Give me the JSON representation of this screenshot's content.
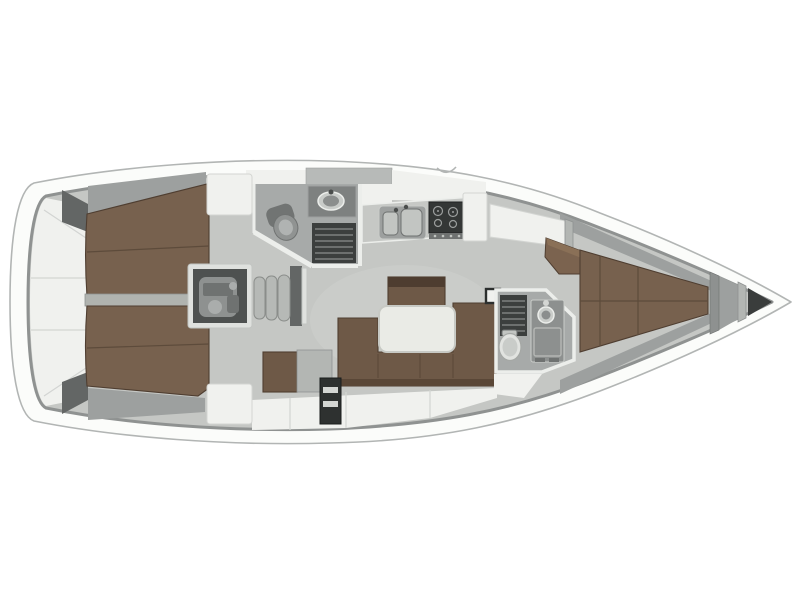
{
  "meta": {
    "description": "Sailing yacht interior floor plan, top-down view, bow pointing right",
    "view": "top-down",
    "bow_direction": "right"
  },
  "colors": {
    "background": "#ffffff",
    "hull_fill": "#fbfcfa",
    "hull_stroke": "#b2b5b4",
    "bulwark": "#8f9291",
    "floor": "#c5c7c4",
    "floor_light": "#cdcfcc",
    "room_floor": "#a7aaa9",
    "deck_white": "#f0f1ee",
    "deck_seam": "#d3d5d2",
    "liner": "#9da09f",
    "wall_white": "#eceeeb",
    "wall_grey": "#b0b3af",
    "bulkhead_dark": "#636665",
    "berth": "#77614e",
    "berth_seam": "#5d4b3b",
    "berth_edge": "#4f3e31",
    "settee": "#6e5947",
    "settee_dark": "#5a4737",
    "island_top": "#4e3d30",
    "wedge": "#7b634f",
    "wedge_top": "#8a7057",
    "table": "#eaebe6",
    "table_edge": "#c7c9c4",
    "counter": "#c6c8c5",
    "counter_dark": "#7e8180",
    "steel": "#9da09f",
    "basin": "#c2c5c2",
    "stove": "#343736",
    "burner": "#9b9e9d",
    "engine_box": "#4e5150",
    "engine_metal": "#8e9190",
    "engine_detail": "#6f7271",
    "step": "#b6b9b6",
    "step_edge": "#8a8d8a",
    "grate": "#3c3f3e",
    "grate_slat": "#6d706f",
    "toilet_grey": "#909392",
    "toilet_white": "#e1e3e0",
    "locker_dark": "#2e3130",
    "locker_slat": "#d4d6d3",
    "cabinet_grey": "#b3b6b3",
    "console": "#8d908f",
    "frame_white": "#dfe1de",
    "hatch": "#b7bab8",
    "mast_frame": "#2c2f2e",
    "anchor": "#3a3d3c",
    "sink_rim": "#c9ccc9",
    "sink_bowl": "#8b8e8d",
    "dark_detail": "#4a4d4c"
  },
  "layout": {
    "rooms": [
      {
        "id": "lazarette",
        "name": "stern lazarette storage",
        "features": [
          "storage-panels",
          "corner-bulkheads"
        ]
      },
      {
        "id": "aft-cabin-upper",
        "name": "aft double cabin (upper side)",
        "features": [
          "double-berth",
          "white-locker",
          "hull-liner-shelf"
        ]
      },
      {
        "id": "aft-cabin-lower",
        "name": "aft double cabin (lower side)",
        "features": [
          "double-berth",
          "white-locker",
          "hull-liner-shelf"
        ]
      },
      {
        "id": "engine-compartment",
        "name": "engine compartment",
        "features": [
          "engine-block"
        ]
      },
      {
        "id": "companionway",
        "name": "companionway steps",
        "features": [
          "three-steps",
          "entry-bulkhead"
        ]
      },
      {
        "id": "aft-head",
        "name": "aft head (bathroom)",
        "features": [
          "oval-sink",
          "toilet",
          "shower-grate",
          "angled-wall"
        ]
      },
      {
        "id": "galley",
        "name": "galley",
        "features": [
          "double-sink",
          "stove-with-burners",
          "counter",
          "white-cabinet"
        ]
      },
      {
        "id": "salon",
        "name": "salon",
        "features": [
          "u-shaped-settee",
          "white-table",
          "storage-island",
          "side-seat",
          "grey-cabinet",
          "floor-locker"
        ]
      },
      {
        "id": "mast-step",
        "name": "mast step",
        "features": []
      },
      {
        "id": "forward-head",
        "name": "forward head (bathroom)",
        "features": [
          "shower-grate",
          "sink-console",
          "toilet"
        ]
      },
      {
        "id": "forward-cabin",
        "name": "forward V-berth cabin",
        "features": [
          "v-berth",
          "corner-wedge-shelf",
          "hull-liner-shelves",
          "white-panel"
        ]
      },
      {
        "id": "bow",
        "name": "bow compartments",
        "features": [
          "bulkheads",
          "anchor-locker"
        ]
      }
    ]
  }
}
